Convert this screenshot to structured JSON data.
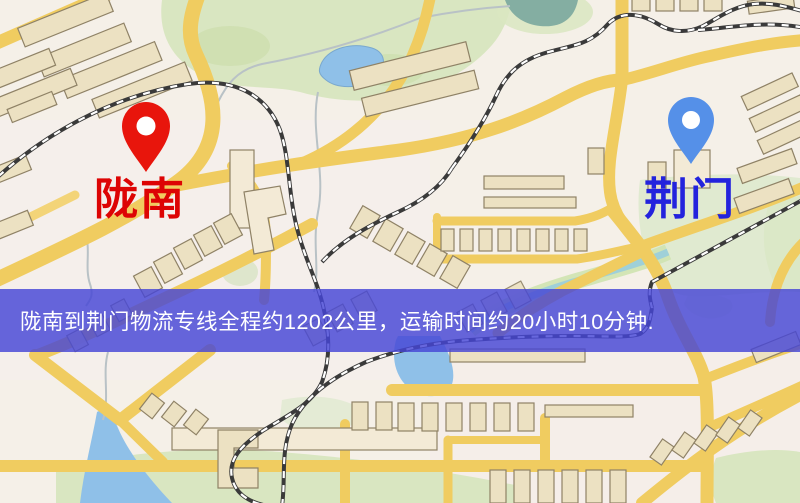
{
  "map": {
    "type": "route-overview-map",
    "banner": {
      "text": "陇南到荆门物流专线全程约1202公里，运输时间约20小时10分钟.",
      "bg_color": "#4646d6",
      "text_color": "#ffffff"
    },
    "route_info": {
      "origin": "陇南",
      "destination": "荆门",
      "service": "物流专线",
      "distance_km": 1202,
      "duration": "20小时10分钟"
    },
    "markers": [
      {
        "id": "origin",
        "label": "陇南",
        "pin_color": "#e8150c",
        "label_color": "#dd0404"
      },
      {
        "id": "destination",
        "label": "荆门",
        "pin_color": "#5590e8",
        "label_color": "#2323dd"
      }
    ]
  },
  "palette": {
    "background": "#f5f0e8",
    "road": "#f0cc60",
    "park": "#d9e6c1",
    "water": "#8fc0e8",
    "railway": "#3a3a3a",
    "origin-pin": "#e8150c",
    "origin-label": "#dd0404",
    "dest-pin": "#5590e8",
    "dest-label": "#2323dd",
    "banner-text": "#ffffff"
  }
}
